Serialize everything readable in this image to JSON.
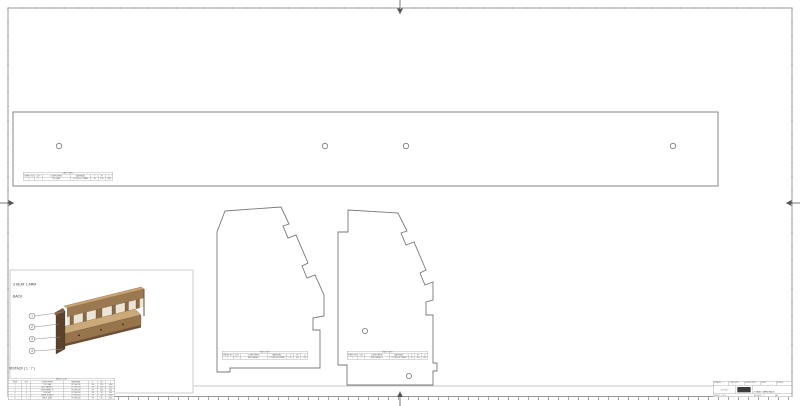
{
  "colors": {
    "frame": "#999999",
    "linework": "#787878",
    "viewport_box": "#c8c8c8",
    "wood_light": "#cbaa79",
    "wood_mid": "#9a7850",
    "wood_dark": "#5a422c",
    "text": "#3a3a3a"
  },
  "assembly": {
    "title_line1": "3 SEAT 1 ARM",
    "title_line2": "BACK",
    "view_label": "VISTA20 ( 1 : 7 )",
    "balloons": [
      "1",
      "2",
      "3",
      "4"
    ]
  },
  "plank_table": {
    "title": "PART INFO",
    "headers": [
      "SHEET NO",
      "QTY",
      "COMPONENT",
      "MATERIAL",
      "T",
      "W",
      "L"
    ],
    "rows": [
      [
        "1",
        "1",
        "TOP RAIL",
        "PLYWOOD 18MM",
        "18",
        "120",
        "2360"
      ]
    ]
  },
  "left_panel_table": {
    "title": "PART INFO",
    "headers": [
      "SHEET NO",
      "QTY",
      "COMPONENT",
      "MATERIAL",
      "T",
      "W",
      "L"
    ],
    "rows": [
      [
        "1",
        "1",
        "END PANEL L",
        "PLYWOOD 18MM",
        "18",
        "310",
        "520"
      ]
    ]
  },
  "right_panel_table": {
    "title": "PART INFO",
    "headers": [
      "SHEET NO",
      "QTY",
      "COMPONENT",
      "MATERIAL",
      "T",
      "W",
      "L"
    ],
    "rows": [
      [
        "1",
        "1",
        "END PANEL R",
        "PLYWOOD 18MM",
        "18",
        "310",
        "560"
      ]
    ]
  },
  "bom_table": {
    "title": "PARTS LIST",
    "headers": [
      "ITEM",
      "QTY",
      "COMPONENT",
      "MATERIAL",
      "T",
      "W",
      "L"
    ],
    "rows": [
      [
        "1",
        "1",
        "TOP RAIL",
        "PLYWOOD",
        "18",
        "120",
        "2360"
      ],
      [
        "2",
        "1",
        "END PANEL L",
        "PLYWOOD",
        "18",
        "310",
        "520"
      ],
      [
        "3",
        "1",
        "END PANEL R",
        "PLYWOOD",
        "18",
        "310",
        "560"
      ],
      [
        "4",
        "3",
        "DIVIDER",
        "PLYWOOD",
        "18",
        "90",
        "310"
      ],
      [
        "5",
        "1",
        "BASE BOARD",
        "PLYWOOD",
        "18",
        "150",
        "2320"
      ],
      [
        "6",
        "1",
        "BACK SLAT",
        "PLYWOOD",
        "18",
        "60",
        "2320"
      ]
    ]
  },
  "title_block": {
    "row1": [
      "DRAWN",
      "CHECKED",
      "APPROVED",
      "DATE",
      "SCALE"
    ],
    "logo_text": "studio",
    "drawing_title": "3 SEAT 1 ARM BACK",
    "row3": [
      "SHEET 1 OF 1",
      "SCALE 1 : 7",
      "A1"
    ]
  }
}
